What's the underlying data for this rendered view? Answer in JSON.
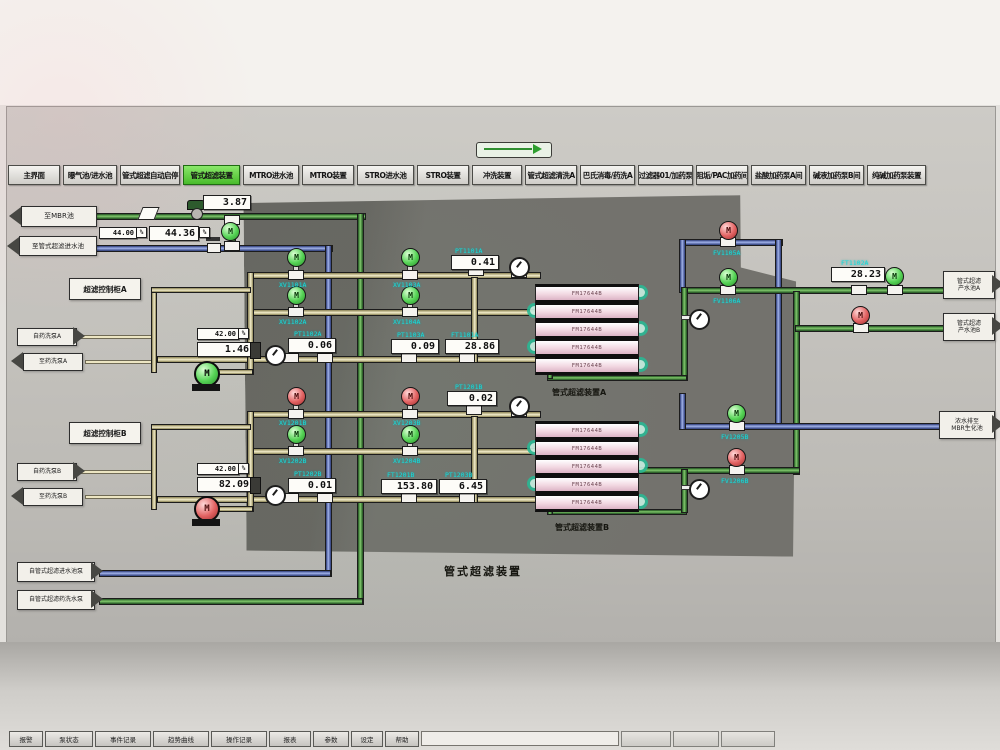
{
  "header": {
    "title": "水处理系统",
    "timestamp": "2025/8/25  10:40:10"
  },
  "nav": {
    "items": [
      "主界面",
      "曝气池/进水池",
      "管式超滤自动启停",
      "管式超滤装置",
      "MTRO进水池",
      "MTRO装置",
      "STRO进水池",
      "STRO装置",
      "冲洗装置",
      "管式超滤清洗A",
      "巴氏消毒/药洗A",
      "过滤器01/加药泵",
      "阻垢/PAC加药间",
      "盐酸加药泵A间",
      "碱液加药泵B间",
      "纯碱加药泵装置"
    ]
  },
  "io": {
    "left": [
      {
        "label": "至MBR池"
      },
      {
        "label": "至管式超滤进水池"
      },
      {
        "label": "自药洗泵A"
      },
      {
        "label": "至药洗泵A"
      },
      {
        "label": "自药洗泵B"
      },
      {
        "label": "至药洗泵B"
      },
      {
        "label": "自管式超滤进水池泵"
      },
      {
        "label": "自管式超滤药洗水泵"
      }
    ],
    "right": [
      {
        "l1": "管式超滤",
        "l2": "产水池A"
      },
      {
        "l1": "管式超滤",
        "l2": "产水池B"
      },
      {
        "l1": "浓水排至",
        "l2": "MBR生化池"
      }
    ]
  },
  "values": [
    {
      "tag": "",
      "val": "3.87"
    },
    {
      "tag": "",
      "sp": "44.00",
      "val": "44.36"
    },
    {
      "tag": "PT1101A",
      "val": "0.41"
    },
    {
      "tag": "",
      "sp": "42.00",
      "val": "1.46"
    },
    {
      "tag": "PT1102A",
      "val": "0.06"
    },
    {
      "tag": "PT1103A",
      "val": "0.09"
    },
    {
      "tag": "FT1101A",
      "val": "28.86"
    },
    {
      "tag": "FT1102A",
      "val": "28.23"
    },
    {
      "tag": "PT1201B",
      "val": "0.02"
    },
    {
      "tag": "",
      "sp": "42.00",
      "val": "82.09"
    },
    {
      "tag": "PT1202B",
      "val": "0.01"
    },
    {
      "tag": "FT1201B",
      "val": "153.80"
    },
    {
      "tag": "PT1203B",
      "val": "6.45"
    }
  ],
  "valves": [
    {
      "tag": "XV1101A"
    },
    {
      "tag": "XV1103A"
    },
    {
      "tag": "XV1102A"
    },
    {
      "tag": "XV1104A"
    },
    {
      "tag": "FV1105A"
    },
    {
      "tag": "FV1106A"
    },
    {
      "tag": "XV1201B"
    },
    {
      "tag": "XV1203B"
    },
    {
      "tag": "XV1202B"
    },
    {
      "tag": "XV1204B"
    },
    {
      "tag": "FV1205B"
    },
    {
      "tag": "FV1206B"
    }
  ],
  "modules": {
    "label": "FM17644B"
  },
  "captions": {
    "unit_a": "管式超滤装置A",
    "unit_b": "管式超滤装置B",
    "system": "管式超滤装置",
    "cab_a": "超滤控制柜A",
    "cab_b": "超滤控制柜B"
  },
  "footer": {
    "tabs": [
      "报警",
      "泵状态",
      "事件记录",
      "趋势曲线",
      "操作记录",
      "报表",
      "参数",
      "设定",
      "帮助"
    ]
  },
  "misc": {
    "m": "M",
    "percent": "%"
  },
  "colors": {
    "active_tab": "#58c838",
    "pipe_green": "#2f7d2f",
    "pipe_blue": "#3a4a8a",
    "pipe_cip": "#efe7c2",
    "tag_cyan": "#18dcdc",
    "valve_open": "#45c945",
    "valve_closed": "#d94f4f"
  }
}
